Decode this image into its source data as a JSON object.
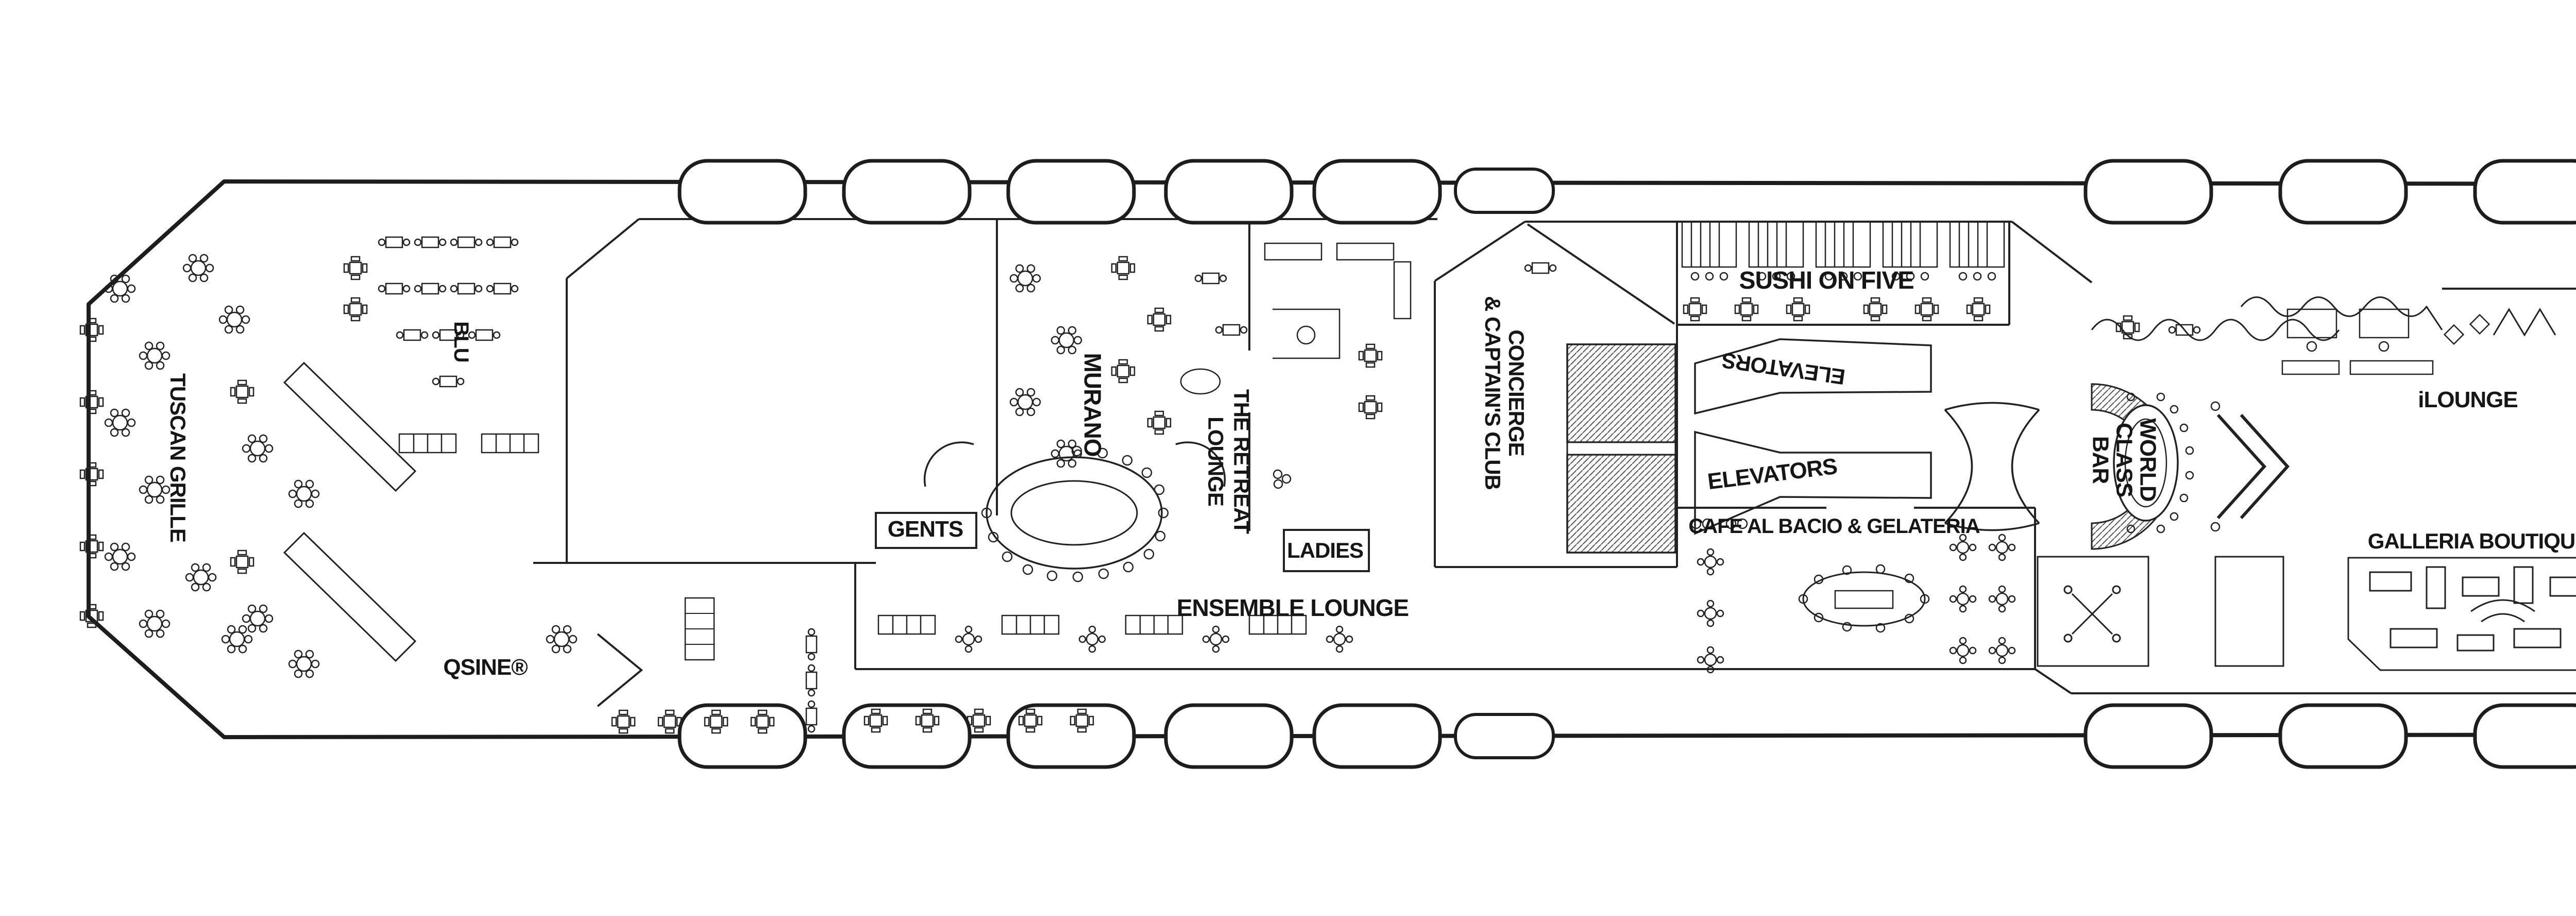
{
  "page": {
    "background": "#ffffff",
    "ink": "#1f1f1f"
  },
  "labels": [
    {
      "id": "tuscan-grille",
      "text": "TUSCAN GRILLE"
    },
    {
      "id": "blu",
      "text": "BLU"
    },
    {
      "id": "qsine",
      "text": "QSINE®"
    },
    {
      "id": "gents-aft",
      "text": "GENTS"
    },
    {
      "id": "murano",
      "text": "MURANO"
    },
    {
      "id": "retreat-lounge",
      "text": "THE RETREAT\nLOUNGE"
    },
    {
      "id": "ladies-aft",
      "text": "LADIES"
    },
    {
      "id": "ensemble-lounge",
      "text": "ENSEMBLE LOUNGE"
    },
    {
      "id": "concierge-captains-club",
      "text": "CONCIERGE\n& CAPTAIN'S CLUB"
    },
    {
      "id": "sushi-on-five",
      "text": "SUSHI ON FIVE"
    },
    {
      "id": "elevators-upper",
      "text": "ELEVATORS"
    },
    {
      "id": "elevators-lower",
      "text": "ELEVATORS"
    },
    {
      "id": "cafe-al-bacio",
      "text": "CAFE AL BACIO & GELATERIA"
    },
    {
      "id": "world-class-bar",
      "text": "WORLD\nCLASS\nBAR"
    },
    {
      "id": "ilounge",
      "text": "iLOUNGE"
    },
    {
      "id": "art-gallery",
      "text": "ART GALLERY"
    },
    {
      "id": "galleria-boutiques-aft",
      "text": "GALLERIA BOUTIQUES"
    },
    {
      "id": "galleria-boutiques-fwd",
      "text": "GALLERIA BOUTIQUES"
    },
    {
      "id": "gents-fwd",
      "text": "GENTS"
    },
    {
      "id": "elevators-fwd",
      "text": "ELEVATORS"
    },
    {
      "id": "ladies-fwd",
      "text": "LADIES"
    },
    {
      "id": "the-theatre",
      "text": "THE\nTHEATRE"
    }
  ]
}
